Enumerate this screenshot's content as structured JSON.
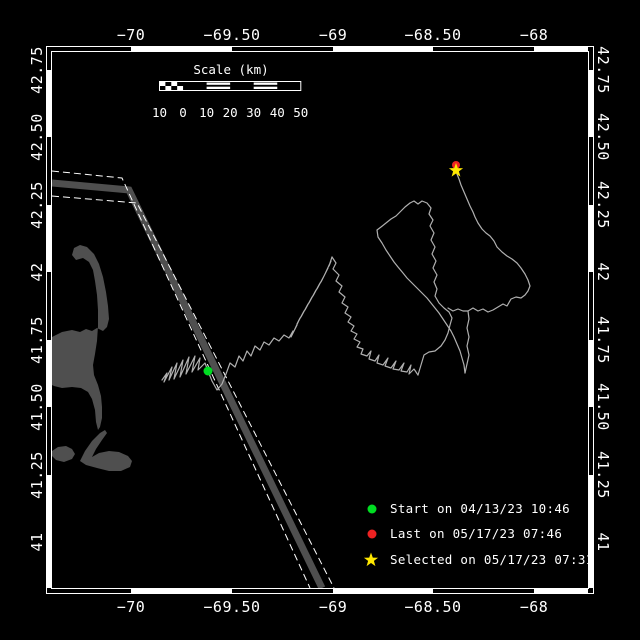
{
  "window": {
    "width": 640,
    "height": 640,
    "background": "#000000"
  },
  "map": {
    "plot": {
      "left": 52,
      "top": 52,
      "right": 588,
      "bottom": 588
    },
    "frame": {
      "outer_offset": 6,
      "horizontal_white_segments": [
        [
          131,
          232
        ],
        [
          333,
          433
        ],
        [
          534,
          588
        ]
      ],
      "vertical_white_segments": [
        [
          70,
          137
        ],
        [
          205,
          272
        ],
        [
          340,
          407
        ],
        [
          475,
          542
        ],
        [
          542,
          588
        ]
      ]
    },
    "lon_ticks": [
      {
        "label": "−70",
        "x": 131
      },
      {
        "label": "−69.50",
        "x": 232
      },
      {
        "label": "−69",
        "x": 333
      },
      {
        "label": "−68.50",
        "x": 433
      },
      {
        "label": "−68",
        "x": 534
      }
    ],
    "lat_ticks": [
      {
        "label": "42.75",
        "y": 70
      },
      {
        "label": "42.50",
        "y": 137
      },
      {
        "label": "42.25",
        "y": 205
      },
      {
        "label": "42",
        "y": 272
      },
      {
        "label": "41.75",
        "y": 340
      },
      {
        "label": "41.50",
        "y": 407
      },
      {
        "label": "41.25",
        "y": 475
      },
      {
        "label": "41",
        "y": 542
      }
    ]
  },
  "scale_bar": {
    "title": "Scale (km)",
    "tick_labels": [
      "10",
      "0",
      "10",
      "20",
      "30",
      "40",
      "50"
    ],
    "x_left": 159.5,
    "x_right": 300.8,
    "bar_top": 81.5,
    "bar_height": 9,
    "label_y": 117,
    "title_x": 231,
    "title_y": 74,
    "segment_styles": [
      "checker",
      "solid",
      "striped",
      "solid",
      "striped",
      "solid"
    ]
  },
  "legend": {
    "x_marker": 372,
    "x_text": 390,
    "rows": [
      {
        "marker": "start-dot",
        "color": "#00dd22",
        "label": "Start on 04/13/23 10:46",
        "y": 509
      },
      {
        "marker": "last-dot",
        "color": "#ee2222",
        "label": "Last on 05/17/23 07:46",
        "y": 534
      },
      {
        "marker": "selected-star",
        "color": "#ffe800",
        "label": "Selected on 05/17/23 07:31",
        "y": 560
      }
    ]
  },
  "markers": {
    "start": {
      "x": 208,
      "y": 371,
      "r": 4.5,
      "color": "#00dd22"
    },
    "last": {
      "x": 456,
      "y": 165,
      "r": 4,
      "color": "#ee2222"
    },
    "selected": {
      "x": 456,
      "y": 170.5,
      "R": 7.5,
      "r": 3,
      "color": "#ffe800"
    }
  },
  "colors": {
    "land": "#4f4f4f",
    "lane_center": "#4f4f4f",
    "track": "#b0b0b0",
    "frame": "#ffffff",
    "text": "#ffffff"
  },
  "geo": {
    "land_paths": [
      "M52,337 L62,332 L72,330 L80,332 L86,329 L92,331 L97,328 L103,331 L107,327 L109,319 L108,306 L106,292 L103,277 L99,264 L94,254 L87,247 L80,245 L74,248 L72,255 L76,260 L83,258 L89,262 L93,270 L95,281 L97,295 L98,310 L98,326 L97,341 L95,354 L93,365 L94,375 L98,385 L101,396 L102,407 L102,418 L100,427 L98,430 L96,422 L95,410 L92,399 L88,392 L81,388 L72,387 L62,388 L54,386 L52,385 Z",
      "M52,451 L58,447 L66,446 L72,449 L75,454 L72,459 L64,462 L56,460 L52,456 Z",
      "M80,461 L85,451 L92,441 L100,433 L105,430 L107,433 L102,440 L96,449 L92,457 L99,453 L109,451 L119,452 L128,456 L132,461 L130,467 L121,471 L109,471 L97,468 L86,465 Z"
    ],
    "lane": {
      "center": [
        [
          52,
          183
        ],
        [
          129,
          190
        ],
        [
          322,
          588
        ]
      ],
      "center_width": 7,
      "edges": [
        [
          [
            52,
            171
          ],
          [
            122,
            178
          ],
          [
            310,
            588
          ]
        ],
        [
          [
            52,
            196
          ],
          [
            137,
            203
          ],
          [
            334,
            588
          ]
        ]
      ],
      "dash": "7,4"
    },
    "track_strokes": [
      [
        [
          162,
          380
        ],
        [
          167,
          373
        ],
        [
          164,
          382
        ],
        [
          172,
          367
        ],
        [
          169,
          380
        ],
        [
          177,
          363
        ],
        [
          174,
          379
        ],
        [
          183,
          360
        ],
        [
          180,
          377
        ],
        [
          189,
          357
        ],
        [
          186,
          374
        ],
        [
          195,
          356
        ],
        [
          192,
          372
        ],
        [
          200,
          358
        ],
        [
          198,
          370
        ],
        [
          205,
          363
        ],
        [
          208,
          371
        ],
        [
          212,
          381
        ],
        [
          217,
          390
        ],
        [
          222,
          384
        ],
        [
          226,
          374
        ],
        [
          230,
          363
        ],
        [
          235,
          367
        ],
        [
          239,
          356
        ],
        [
          243,
          361
        ],
        [
          247,
          351
        ],
        [
          251,
          356
        ],
        [
          255,
          346
        ],
        [
          260,
          350
        ],
        [
          264,
          342
        ],
        [
          269,
          345
        ],
        [
          274,
          338
        ],
        [
          279,
          341
        ],
        [
          284,
          335
        ],
        [
          289,
          338
        ],
        [
          293,
          331
        ],
        [
          291,
          337
        ],
        [
          297,
          325
        ],
        [
          294,
          331
        ],
        [
          300,
          318
        ],
        [
          297,
          324
        ],
        [
          304,
          311
        ],
        [
          301,
          317
        ],
        [
          308,
          304
        ],
        [
          305,
          310
        ],
        [
          312,
          297
        ],
        [
          309,
          303
        ],
        [
          316,
          290
        ],
        [
          313,
          296
        ],
        [
          320,
          283
        ],
        [
          317,
          289
        ],
        [
          324,
          276
        ],
        [
          321,
          282
        ],
        [
          328,
          268
        ],
        [
          325,
          274
        ],
        [
          331,
          261
        ],
        [
          329,
          266
        ],
        [
          332,
          257
        ]
      ],
      [
        [
          332,
          257
        ],
        [
          336,
          263
        ],
        [
          333,
          269
        ],
        [
          339,
          275
        ],
        [
          336,
          281
        ],
        [
          342,
          286
        ],
        [
          339,
          292
        ],
        [
          345,
          297
        ],
        [
          342,
          303
        ],
        [
          348,
          307
        ],
        [
          345,
          313
        ],
        [
          351,
          317
        ],
        [
          348,
          322
        ],
        [
          354,
          326
        ],
        [
          351,
          331
        ],
        [
          357,
          334
        ],
        [
          354,
          339
        ],
        [
          360,
          342
        ],
        [
          357,
          347
        ],
        [
          363,
          349
        ],
        [
          361,
          354
        ],
        [
          367,
          356
        ],
        [
          371,
          351
        ],
        [
          369,
          359
        ],
        [
          375,
          361
        ],
        [
          379,
          355
        ],
        [
          377,
          363
        ],
        [
          383,
          365
        ],
        [
          388,
          358
        ],
        [
          385,
          366
        ],
        [
          391,
          368
        ],
        [
          396,
          361
        ],
        [
          393,
          369
        ],
        [
          399,
          370
        ],
        [
          404,
          363
        ],
        [
          401,
          371
        ],
        [
          407,
          372
        ],
        [
          411,
          365
        ],
        [
          409,
          374
        ],
        [
          414,
          369
        ],
        [
          418,
          375
        ]
      ],
      [
        [
          418,
          375
        ],
        [
          421,
          365
        ],
        [
          424,
          355
        ],
        [
          429,
          352
        ],
        [
          435,
          351
        ],
        [
          441,
          346
        ],
        [
          445,
          340
        ],
        [
          448,
          333
        ],
        [
          450,
          325
        ],
        [
          452,
          318
        ],
        [
          449,
          312
        ],
        [
          444,
          308
        ],
        [
          439,
          303
        ],
        [
          435,
          296
        ],
        [
          437,
          289
        ],
        [
          434,
          282
        ],
        [
          437,
          275
        ],
        [
          433,
          268
        ],
        [
          436,
          261
        ],
        [
          432,
          254
        ],
        [
          435,
          247
        ],
        [
          431,
          240
        ],
        [
          434,
          233
        ],
        [
          430,
          226
        ],
        [
          433,
          220
        ],
        [
          429,
          214
        ],
        [
          431,
          208
        ],
        [
          427,
          203
        ],
        [
          422,
          201
        ],
        [
          418,
          204
        ],
        [
          414,
          201
        ],
        [
          410,
          203
        ]
      ],
      [
        [
          410,
          203
        ],
        [
          405,
          207
        ],
        [
          400,
          212
        ],
        [
          396,
          216
        ],
        [
          391,
          219
        ],
        [
          386,
          223
        ],
        [
          381,
          227
        ],
        [
          377,
          230
        ],
        [
          378,
          237
        ],
        [
          382,
          243
        ],
        [
          386,
          250
        ],
        [
          390,
          256
        ],
        [
          394,
          262
        ],
        [
          398,
          267
        ],
        [
          403,
          273
        ],
        [
          407,
          278
        ],
        [
          412,
          283
        ],
        [
          417,
          288
        ],
        [
          422,
          293
        ],
        [
          427,
          298
        ],
        [
          431,
          303
        ],
        [
          435,
          308
        ],
        [
          439,
          313
        ],
        [
          443,
          319
        ],
        [
          447,
          325
        ],
        [
          451,
          331
        ],
        [
          454,
          337
        ],
        [
          457,
          344
        ],
        [
          460,
          351
        ],
        [
          462,
          358
        ],
        [
          464,
          365
        ],
        [
          465,
          373
        ]
      ],
      [
        [
          465,
          373
        ],
        [
          467,
          364
        ],
        [
          469,
          355
        ],
        [
          467,
          346
        ],
        [
          469,
          337
        ],
        [
          467,
          328
        ],
        [
          469,
          319
        ],
        [
          468,
          311
        ]
      ],
      [
        [
          448,
          308
        ],
        [
          453,
          311
        ],
        [
          458,
          309
        ],
        [
          463,
          311
        ],
        [
          468,
          311
        ],
        [
          473,
          308
        ],
        [
          478,
          311
        ],
        [
          483,
          309
        ],
        [
          488,
          312
        ],
        [
          493,
          310
        ],
        [
          498,
          307
        ],
        [
          503,
          304
        ],
        [
          507,
          306
        ],
        [
          511,
          299
        ],
        [
          516,
          297
        ],
        [
          521,
          298
        ],
        [
          525,
          295
        ],
        [
          528,
          291
        ],
        [
          530,
          286
        ],
        [
          528,
          280
        ],
        [
          525,
          274
        ],
        [
          521,
          268
        ],
        [
          517,
          263
        ],
        [
          512,
          259
        ],
        [
          507,
          256
        ],
        [
          502,
          252
        ],
        [
          497,
          247
        ],
        [
          494,
          241
        ],
        [
          490,
          236
        ],
        [
          486,
          233
        ],
        [
          482,
          229
        ],
        [
          478,
          223
        ],
        [
          475,
          217
        ],
        [
          473,
          212
        ],
        [
          470,
          206
        ],
        [
          467,
          199
        ],
        [
          464,
          192
        ],
        [
          461,
          185
        ],
        [
          459,
          179
        ],
        [
          457,
          174
        ],
        [
          456,
          170
        ]
      ]
    ]
  }
}
